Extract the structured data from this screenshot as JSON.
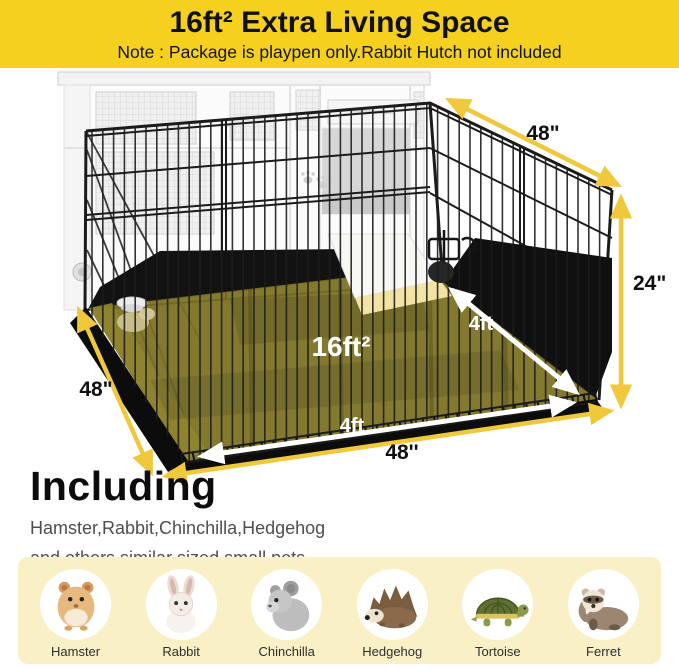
{
  "banner": {
    "title": "16ft² Extra Living Space",
    "note": "Note : Package is playpen only.Rabbit Hutch not included",
    "background_color": "#F5D01E"
  },
  "diagram": {
    "area_label": "16ft²",
    "dim_top_right": "48\"",
    "dim_right": "24\"",
    "dim_left": "48\"",
    "dim_bottom": "48''",
    "dim_floor_right": "4ft",
    "dim_floor_front": "4ft",
    "arrow_color": "#EFC83C",
    "mat_color": "#7A7020",
    "wire_color": "#1d1d1d"
  },
  "including": {
    "heading": "Including",
    "line1": "Hamster,Rabbit,Chinchilla,Hedgehog",
    "line2": "and others similar sized small pets"
  },
  "footer_panel": {
    "background_color": "#FAF0C6",
    "animals": [
      {
        "name": "Hamster"
      },
      {
        "name": "Rabbit"
      },
      {
        "name": "Chinchilla"
      },
      {
        "name": "Hedgehog"
      },
      {
        "name": "Tortoise"
      },
      {
        "name": "Ferret"
      }
    ]
  }
}
